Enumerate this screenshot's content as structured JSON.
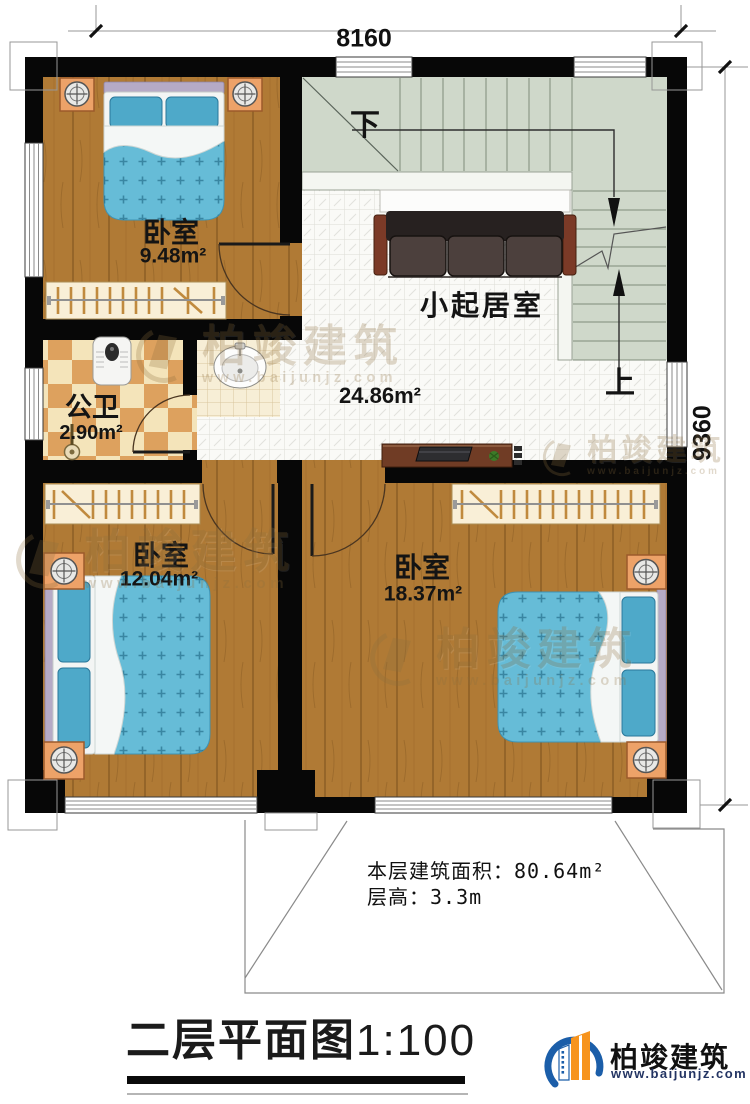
{
  "dimensions": {
    "top": "8160",
    "right": "9360"
  },
  "rooms": [
    {
      "name": "卧室",
      "area": "9.48m²"
    },
    {
      "name": "公卫",
      "area": "2.90m²"
    },
    {
      "name": "小起居室",
      "area": "24.86m²"
    },
    {
      "name": "卧室",
      "area": "12.04m²"
    },
    {
      "name": "卧室",
      "area": "18.37m²"
    }
  ],
  "stairs": {
    "down": "下",
    "up": "上"
  },
  "info": {
    "area_line": "本层建筑面积：80.64m²",
    "height_line": "层高：3.3m"
  },
  "footer": {
    "title": "二层平面图",
    "scale": "1:100"
  },
  "brand": {
    "name": "柏竣建筑",
    "website": "www.baijunjz.com"
  },
  "watermark": {
    "name": "柏竣建筑",
    "website": "www.baijunjz.com"
  },
  "colors": {
    "wall": "#070707",
    "wood_floor": "#b07a35",
    "stair_floor": "#cfd8ca",
    "bathroom_tile": "#dda15e",
    "bed_blue": "#66bcd7",
    "brand_blue": "#1b5ea9",
    "brand_orange": "#f7941d"
  }
}
